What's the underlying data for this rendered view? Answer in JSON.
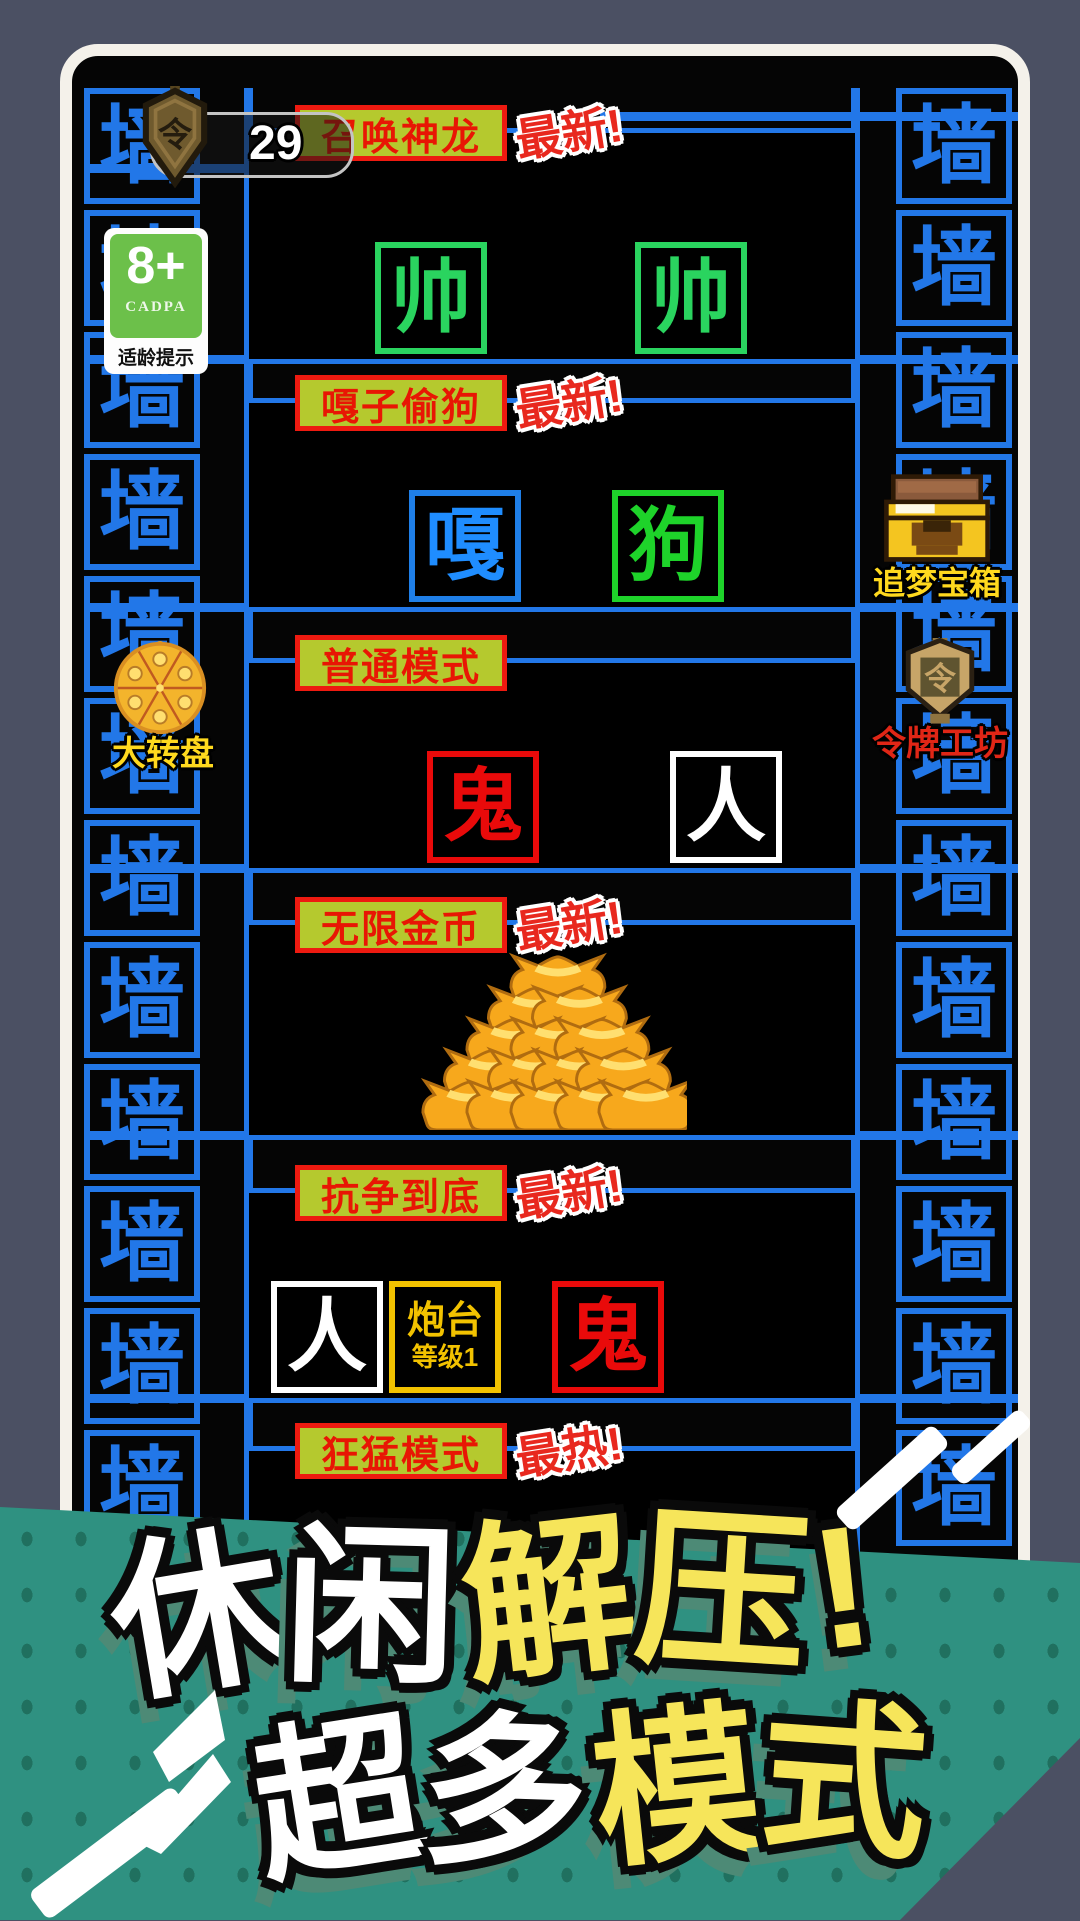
{
  "walls": {
    "glyph": "墙"
  },
  "hud": {
    "token": {
      "count": "29",
      "glyph": "令"
    },
    "age": {
      "rating": "8+",
      "org": "CADPA",
      "caption": "适龄提示"
    },
    "wheel": {
      "label": "大转盘"
    },
    "chest": {
      "label": "追梦宝箱"
    },
    "workshop": {
      "label": "令牌工坊",
      "glyph": "令"
    }
  },
  "panels": [
    {
      "title": "召唤神龙",
      "badge": "最新!",
      "items": [
        {
          "char": "帅"
        },
        {
          "char": "帅"
        }
      ]
    },
    {
      "title": "嘎子偷狗",
      "badge": "最新!",
      "items": [
        {
          "char": "嘎"
        },
        {
          "char": "狗"
        }
      ]
    },
    {
      "title": "普通模式",
      "badge": "",
      "items": [
        {
          "char": "鬼"
        },
        {
          "char": "人"
        }
      ]
    },
    {
      "title": "无限金币",
      "badge": "最新!",
      "items": []
    },
    {
      "title": "抗争到底",
      "badge": "最新!",
      "items": [
        {
          "char": "人"
        },
        {
          "name": "炮台",
          "level": "等级1"
        },
        {
          "char": "鬼"
        }
      ]
    },
    {
      "title": "狂猛模式",
      "badge": "最热!",
      "items": []
    }
  ],
  "banner": {
    "line1": [
      "休",
      "闲",
      "解",
      "压",
      "!"
    ],
    "line2": [
      "超",
      "多",
      "模",
      "式"
    ]
  },
  "colors": {
    "wall_blue": "#2277e8",
    "tab_bg": "#b5c92e",
    "tab_text": "#e81604",
    "badge_red": "#e8281e",
    "banner_teal": "#2f9181",
    "banner_yellow": "#f6e55a",
    "gold": "#f7a81c"
  }
}
